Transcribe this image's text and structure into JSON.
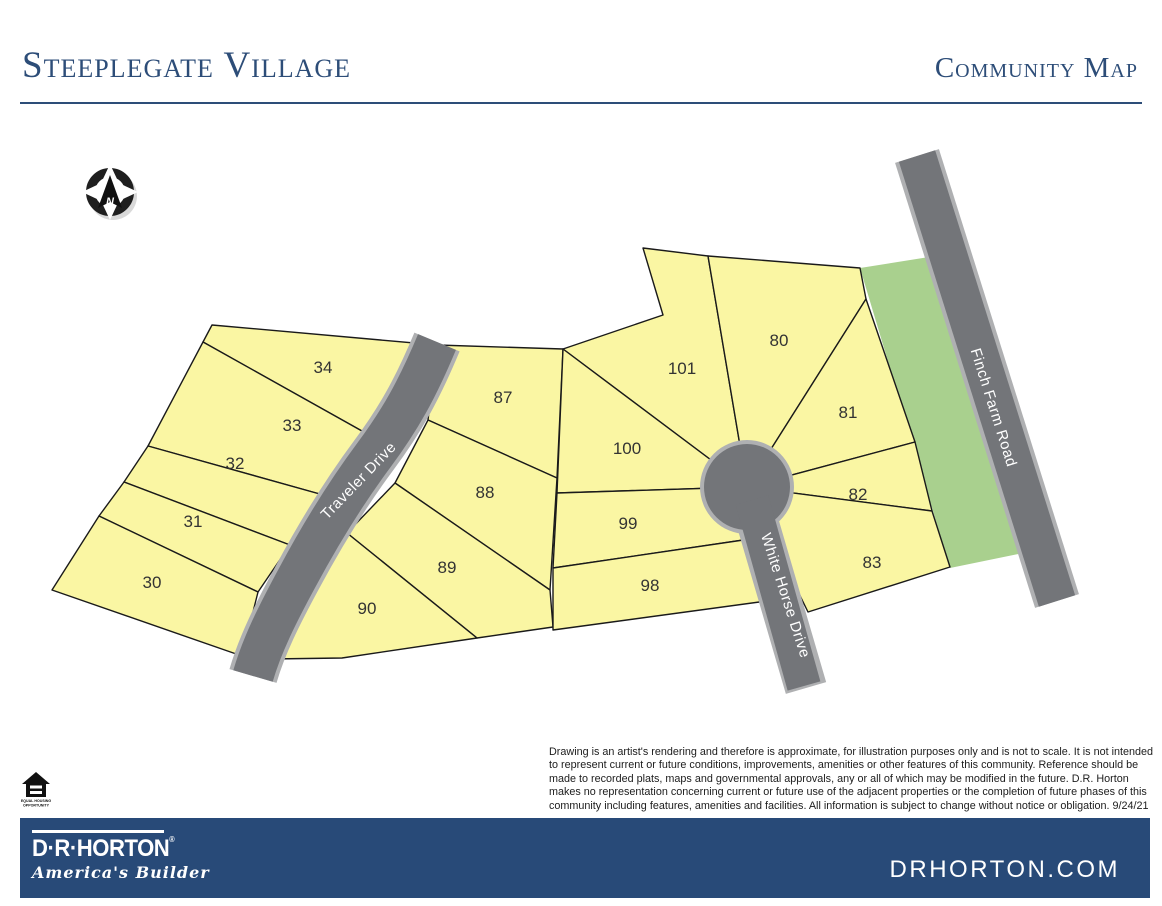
{
  "header": {
    "title": "Steeplegate Village",
    "subtitle": "Community Map"
  },
  "map": {
    "lots": [
      {
        "number": "30",
        "x": 152,
        "y": 588
      },
      {
        "number": "31",
        "x": 193,
        "y": 527
      },
      {
        "number": "32",
        "x": 235,
        "y": 469
      },
      {
        "number": "33",
        "x": 292,
        "y": 431
      },
      {
        "number": "34",
        "x": 323,
        "y": 373
      },
      {
        "number": "87",
        "x": 503,
        "y": 403
      },
      {
        "number": "88",
        "x": 485,
        "y": 498
      },
      {
        "number": "89",
        "x": 447,
        "y": 573
      },
      {
        "number": "90",
        "x": 367,
        "y": 614
      },
      {
        "number": "98",
        "x": 650,
        "y": 591
      },
      {
        "number": "99",
        "x": 628,
        "y": 529
      },
      {
        "number": "100",
        "x": 627,
        "y": 454
      },
      {
        "number": "101",
        "x": 682,
        "y": 374
      },
      {
        "number": "80",
        "x": 779,
        "y": 346
      },
      {
        "number": "81",
        "x": 848,
        "y": 418
      },
      {
        "number": "82",
        "x": 858,
        "y": 500
      },
      {
        "number": "83",
        "x": 872,
        "y": 568
      }
    ],
    "roads": [
      {
        "name": "Traveler Drive",
        "x": 362,
        "y": 484,
        "rotation": -46
      },
      {
        "name": "White Horse Drive",
        "x": 781,
        "y": 597,
        "rotation": 72
      },
      {
        "name": "Finch Farm Road",
        "x": 989,
        "y": 409,
        "rotation": 72.5
      }
    ],
    "compass": {
      "label": "N"
    }
  },
  "disclaimer": "Drawing is an artist's rendering and therefore is approximate, for illustration purposes only and is not to scale. It is not intended to represent current or future conditions, improvements, amenities or other features of this community. Reference should be made to recorded plats, maps and governmental approvals, any or all of which may be modified in the future. D.R. Horton makes no representation concerning current or future use of the adjacent properties or the completion of future phases of this community including features, amenities and facilities. All information is subject to change without notice or obligation. 9/24/21",
  "footer": {
    "logo_wordmark": "D·R·HORTON",
    "logo_mark": "®",
    "logo_tagline": "America's Builder",
    "website": "DRHORTON.COM",
    "equal_housing_line1": "EQUAL HOUSING",
    "equal_housing_line2": "OPPORTUNITY"
  },
  "colors": {
    "lot_fill": "#FAF6A3",
    "lot_stroke": "#1a1a1a",
    "green_fill": "#A9D08E",
    "road_fill": "#737579",
    "road_edge": "#AFB0B2",
    "navy": "#284A78",
    "title_color": "#2D4D78",
    "label_color": "#333333",
    "road_label_color": "#ffffff"
  }
}
